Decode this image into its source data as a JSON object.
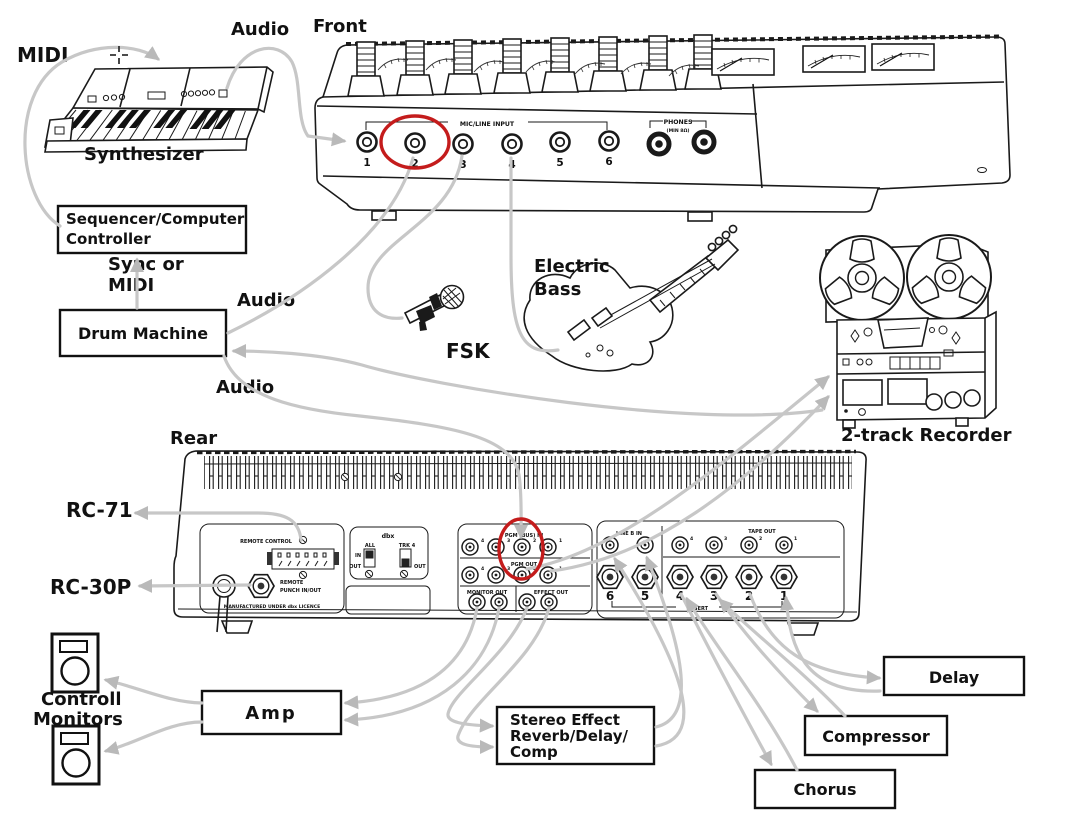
{
  "diagram": {
    "labels": {
      "midi": "MIDI",
      "front": "Front",
      "audio_synth": "Audio",
      "synthesizer": "Synthesizer",
      "sync_line1": "Sync or",
      "sync_line2": "MIDI",
      "audio_drum": "Audio",
      "audio_drum2": "Audio",
      "fsk": "FSK",
      "electric_line1": "Electric",
      "electric_line2": "Bass",
      "recorder": "2-track Recorder",
      "rear": "Rear",
      "rc71": "RC-71",
      "rc30p": "RC-30P",
      "monitors_line1": "Controll",
      "monitors_line2": "Monitors"
    },
    "boxes": {
      "sequencer_line1": "Sequencer/Computer",
      "sequencer_line2": "Controller",
      "drum_machine": "Drum Machine",
      "amp": "Amp",
      "stereo_effect_line1": "Stereo Effect",
      "stereo_effect_line2": "Reverb/Delay/",
      "stereo_effect_line3": "Comp",
      "chorus": "Chorus",
      "compressor": "Compressor",
      "delay": "Delay"
    },
    "front_panel": {
      "group_label": "MIC/LINE INPUT",
      "phones_label": "PHONES",
      "phones_sub": "(MIN 8Ω)",
      "inputs": [
        "1",
        "2",
        "3",
        "4",
        "5",
        "6"
      ]
    },
    "rear_panel": {
      "remote_control": "REMOTE CONTROL",
      "remote_punch_line1": "REMOTE",
      "remote_punch_line2": "PUNCH IN/OUT",
      "licence": "MANUFACTURED UNDER dbx LICENCE",
      "dbx": "dbx",
      "sw_all": "ALL",
      "sw_trk4": "TRK 4",
      "sw_in": "IN",
      "sw_out1": "OUT",
      "sw_out2": "OUT",
      "pgm_in": "PGM (BUS) IN",
      "pgm_out": "PGM OUT",
      "monitor_out": "MONITOR OUT",
      "effect_out": "EFFECT OUT",
      "line_b_in": "LINE B IN",
      "tape_out": "TAPE OUT",
      "insert": "INSERT",
      "jack_numbers": [
        "6",
        "5",
        "4",
        "3",
        "2",
        "1"
      ],
      "pgm_in_numbers": [
        "4",
        "3",
        "2",
        "1"
      ],
      "pgm_out_numbers": [
        "4",
        "3",
        "2",
        "1"
      ],
      "tape_numbers": [
        "4",
        "3",
        "2",
        "1"
      ]
    },
    "colors": {
      "cable": "#c7c7c7",
      "highlight": "#c41c1c",
      "ink": "#1a1a1a"
    }
  }
}
